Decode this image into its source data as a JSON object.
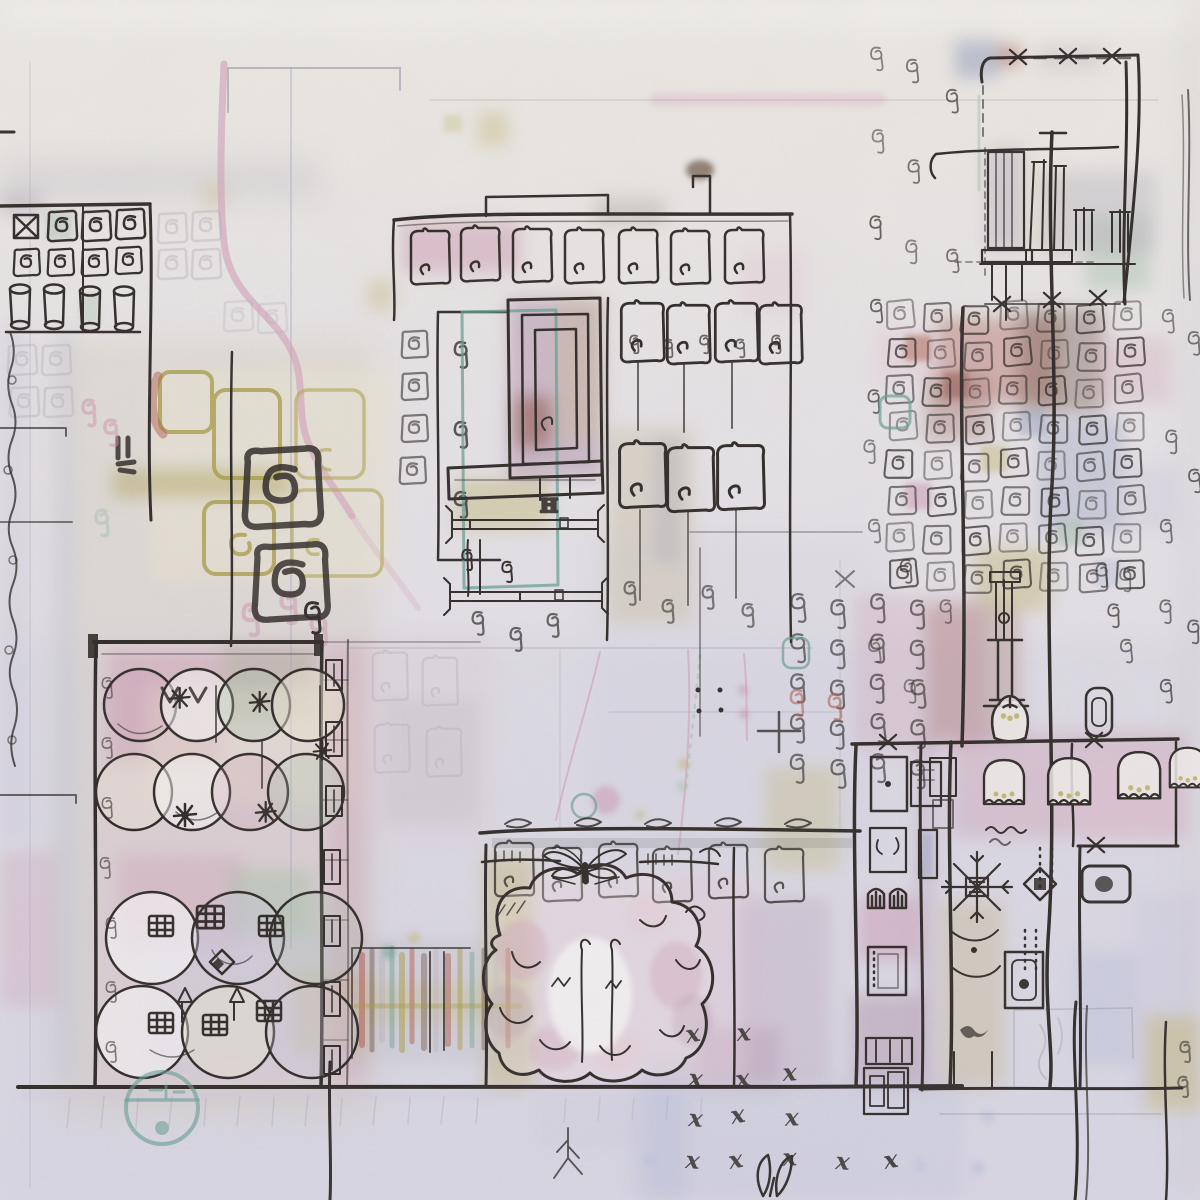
{
  "artwork": {
    "kind": "abstract-ink-and-watercolor-cityscape"
  },
  "marks": {
    "x": "x",
    "plus": "+",
    "h": "H"
  },
  "palette": {
    "paper_top": "#f2efe6",
    "paper_mid": "#eae7ea",
    "paper_low": "#e0dee8",
    "paper_white": "#f6f3ee",
    "ink": "#241f1b",
    "pencil": "#918ba3",
    "pencil_blue": "#a3a7c4",
    "pink_line": "#d9a8bf",
    "rose": "#cf93ad",
    "pink_pale": "#e7c6d4",
    "mauve": "#b08ba6",
    "plum": "#9d6b8c",
    "rust": "#b05a48",
    "brick": "#8f4a3e",
    "olive": "#a89c3e",
    "olive_light": "#b9ad5c",
    "khaki": "#c6b96f",
    "tan": "#cbbd9b",
    "taupe": "#a99d8c",
    "teal": "#5f9d8f",
    "sage": "#a9c4ab",
    "blue_gray": "#93a0c0",
    "periwinkle": "#b7bedd",
    "lavender": "#cfccdf",
    "gray_wash": "#b9b4bd",
    "brown": "#6e5544",
    "cream": "#efe9d4",
    "white": "#ffffff"
  }
}
